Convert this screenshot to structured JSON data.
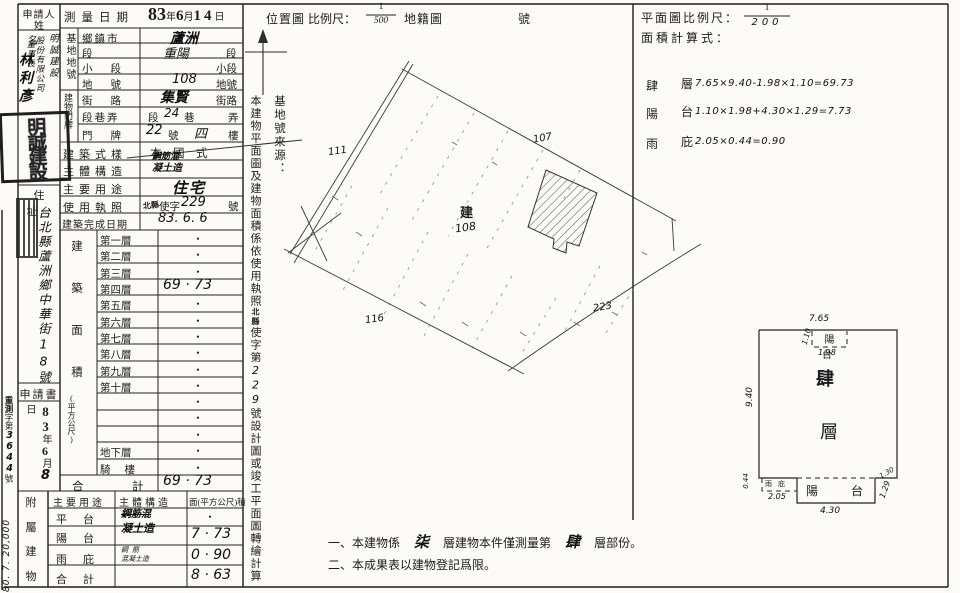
{
  "left_strip": {
    "print_code": "80. 7. 20,000",
    "file_stamp": "重測",
    "file_prefix": "字第",
    "file_number": "3644",
    "file_suffix": "號"
  },
  "applicant": {
    "header_line1": "申請人",
    "header_line2": "姓名",
    "company_col1": "明誠建設",
    "company_col2": "股份有限公司",
    "title": "董事長",
    "name": "林利彥",
    "company_seal": "明誠建設",
    "address_header": "住址",
    "address": "台北縣蘆洲鄉中華街18號",
    "application_header": "申請書",
    "app_date_y": "83",
    "app_date_y_u": "年",
    "app_date_m": "6",
    "app_date_m_u": "月",
    "app_date_d": "8",
    "app_date_d_u": "日"
  },
  "survey_date": {
    "label": "測量日期",
    "y": "83",
    "y_u": "年",
    "m": "6",
    "m_u": "月",
    "d": "14",
    "d_u": "日"
  },
  "site": {
    "group": "基地地號",
    "township_label": "鄉鎮市",
    "township": "蘆洲",
    "section_label": "段",
    "section": "重陽",
    "section_suffix": "段",
    "subsection_label": "小段",
    "subsection_suffix": "小段",
    "lot_label": "地號",
    "lot": "108",
    "lot_suffix": "地號"
  },
  "address_plate": {
    "group": "建物門牌",
    "street_label": "街路",
    "street": "集賢",
    "street_suffix": "街路",
    "lane_label": "段巷弄",
    "lane_pre": "段",
    "lane": "24",
    "lane_mid": "巷",
    "lane_suffix": "弄",
    "door_label": "門牌",
    "door_no": "22",
    "door_mid": "號",
    "door_floor": "四",
    "door_suffix": "樓"
  },
  "building": {
    "style_label": "建築式樣",
    "style_value": "本　國　式",
    "structure_label": "主體構造",
    "structure_value1": "鋼筋混",
    "structure_value2": "凝土造",
    "use_label": "主要用途",
    "use_value": "住宅",
    "license_label": "使用執照",
    "license_stamp": "北縣",
    "license_pre": "使字",
    "license_no": "229",
    "license_suffix": "號",
    "completion_label": "建築完成日期",
    "completion_value": "83. 6. 6"
  },
  "floor_area": {
    "group_chars": {
      "c0": "建",
      "c1": "築",
      "c2": "面",
      "c3": "積"
    },
    "unit": "(平方公尺)",
    "floors": [
      {
        "label": "第一層",
        "value": "•"
      },
      {
        "label": "第二層",
        "value": "•"
      },
      {
        "label": "第三層",
        "value": "•"
      },
      {
        "label": "第四層",
        "value": "69 · 73"
      },
      {
        "label": "第五層",
        "value": "•"
      },
      {
        "label": "第六層",
        "value": "•"
      },
      {
        "label": "第七層",
        "value": "•"
      },
      {
        "label": "第八層",
        "value": "•"
      },
      {
        "label": "第九層",
        "value": "•"
      },
      {
        "label": "第十層",
        "value": "•"
      },
      {
        "label": "",
        "value": "•"
      },
      {
        "label": "",
        "value": "•"
      },
      {
        "label": "",
        "value": "•"
      },
      {
        "label": "地下層",
        "value": "•"
      },
      {
        "label": "騎樓",
        "value": "•"
      }
    ],
    "total_label1": "合",
    "total_label2": "計",
    "total_value": "69 · 73"
  },
  "annex": {
    "group_chars": {
      "c0": "附",
      "c1": "屬",
      "c2": "建",
      "c3": "物"
    },
    "header_use": "主要用途",
    "header_structure": "主體構造",
    "header_area": "面(平方公尺)積",
    "rows": [
      {
        "use": "平台",
        "area": "•"
      },
      {
        "use": "陽台",
        "area": "7 · 73"
      },
      {
        "use": "雨庇",
        "area": "0 · 90"
      },
      {
        "use": "合計",
        "area": "8 · 63"
      }
    ],
    "structure_span1": "鋼筋混",
    "structure_span2": "凝土造",
    "structure_canopy1": "鋼筋",
    "structure_canopy2": "混凝土造"
  },
  "vertical_notes": {
    "col1_seg1": "本建物平面圖及建物面積係依使用執照",
    "col1_stamp": "北縣",
    "col1_seg2": "使字第",
    "col1_num": "229",
    "col1_seg3": "號設計圖或竣工平面圖轉繪計算",
    "col2": "基地號來源："
  },
  "location_map": {
    "title": "位置圖",
    "scale_label": "比例尺：",
    "scale_num": "1",
    "scale_den": "500",
    "map_name": "地籍圖",
    "sheet_no_suffix": "號",
    "lot_left": "111",
    "lot_top": "107",
    "lot_bottom": "116",
    "lot_right": "223",
    "building_mark": "建",
    "parcel_no": "108"
  },
  "plan_section": {
    "scale_label": "平面圖比例尺：",
    "scale_num": "1",
    "scale_den": "200",
    "calc_label": "面積計算式：",
    "calc_lines": [
      {
        "k1": "肆",
        "k2": "層",
        "expr": "7.65×9.40-1.98×1.10=69.73"
      },
      {
        "k1": "陽",
        "k2": "台",
        "expr": "1.10×1.98+4.30×1.29=7.73"
      },
      {
        "k1": "雨",
        "k2": "庇",
        "expr": "2.05×0.44=0.90"
      }
    ]
  },
  "floor_plan": {
    "dim_top": "7.65",
    "balcony_top_label": "陽台",
    "dim_balcony_top_w": "1.98",
    "dim_balcony_top_h": "1.10",
    "dim_left": "9.40",
    "label_char1": "肆",
    "label_char2": "層",
    "canopy_label": "雨庇",
    "dim_canopy_w": "2.05",
    "dim_canopy_h": "0.44",
    "balcony_bottom_label1": "陽",
    "balcony_bottom_label2": "台",
    "dim_balcony_bottom_w": "4.30",
    "dim_balcony_bottom_h": "1.29",
    "dim_step": "1.30"
  },
  "notes": {
    "n1_pre": "一、本建物係",
    "n1_fill1": "柒",
    "n1_mid": "層建物本件僅測量第",
    "n1_fill2": "肆",
    "n1_post": "層部份。",
    "n2": "二、本成果表以建物登記爲限。"
  }
}
